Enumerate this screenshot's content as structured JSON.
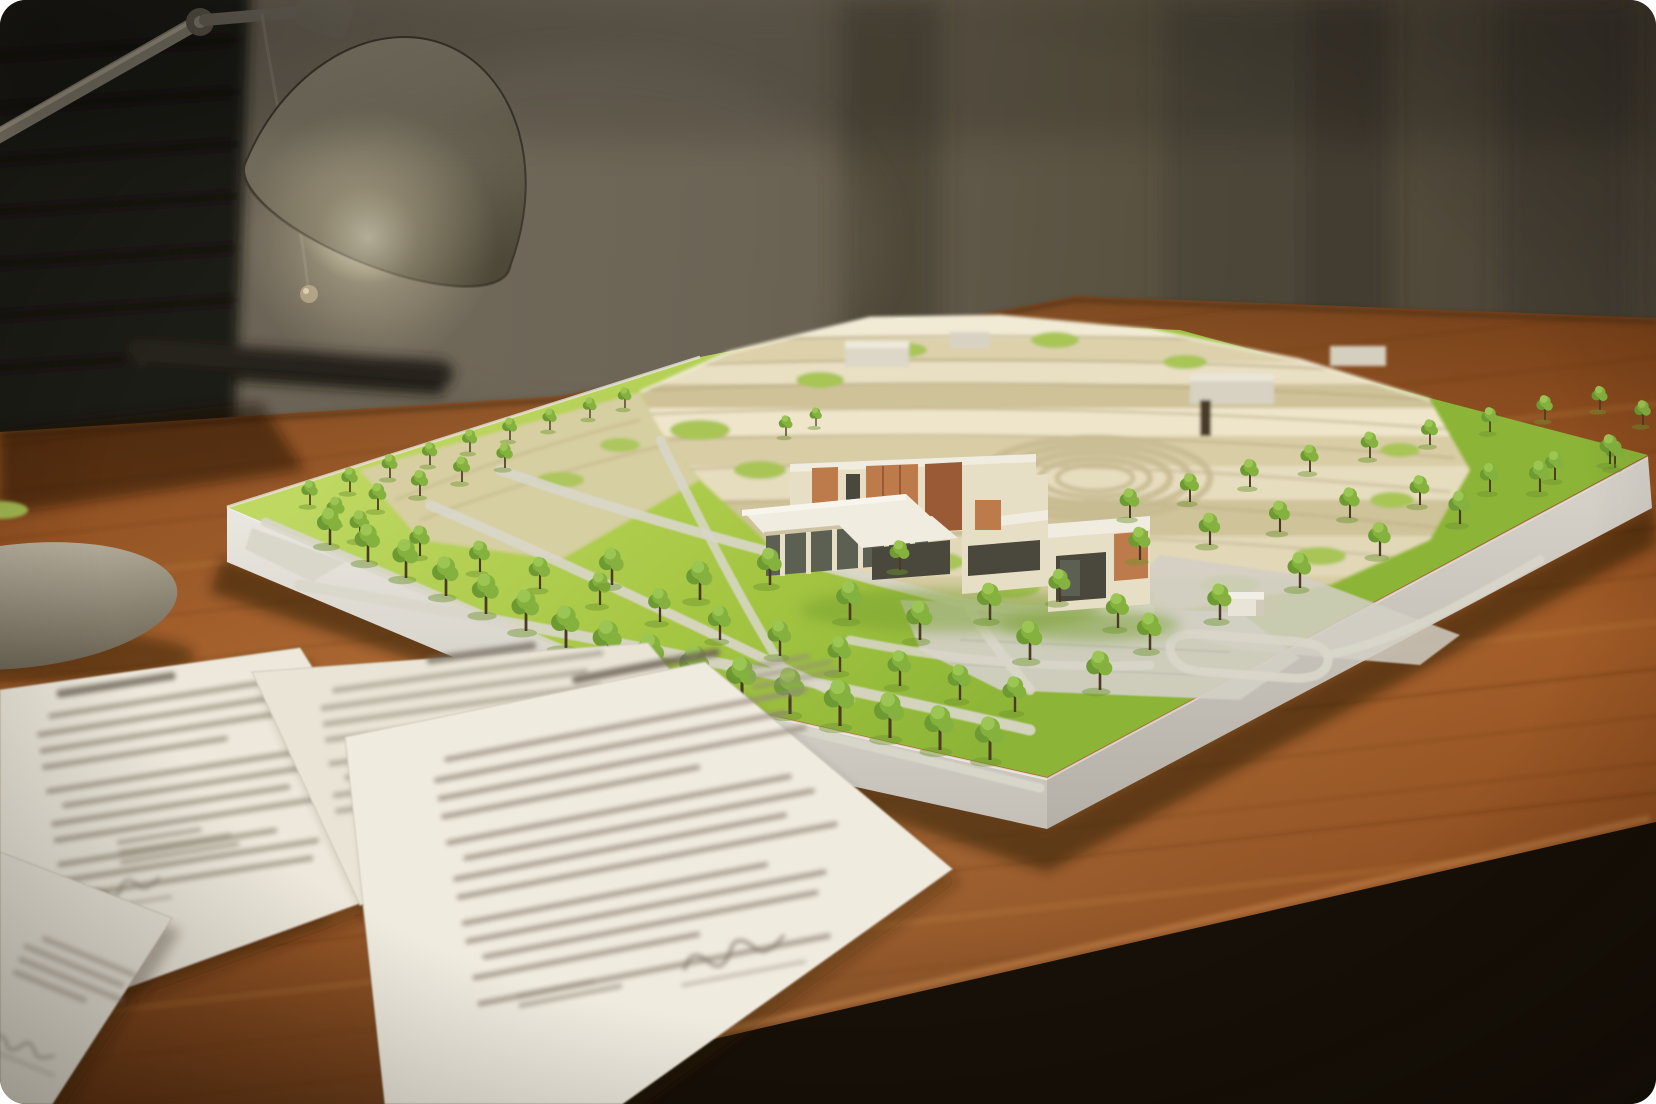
{
  "image": {
    "kind": "photograph",
    "subject": "Architectural terrain model of a hillside site with a modern building, trees and lawns, sitting on a wooden desk lit by a desk lamp, office chair behind, printed documents in the foreground"
  },
  "objects": [
    {
      "name": "office-chair",
      "desc": "dark leather ribbed chair, blurred, top left"
    },
    {
      "name": "desk-lamp",
      "desc": "olive-grey dome shade, articulated silver arm, glowing bulb, pull cord with ball"
    },
    {
      "name": "lamp-base",
      "desc": "round beige weighted base at left edge"
    },
    {
      "name": "desk",
      "desc": "warm reddish-brown wooden desk with grain streaks"
    },
    {
      "name": "architectural-model",
      "desc": "white baseboard, green lawns, grey footpaths, cream terraced hillside, modern cream building with terracotta slats, many miniature trees"
    },
    {
      "name": "documents",
      "desc": "overlapping white printed sheets with blurred illegible text and signatures"
    }
  ],
  "palette": {
    "wall": "#6f6759",
    "wallMid": "#5c5447",
    "wallDark": "#3b352b",
    "chair": "#1e1b17",
    "chairRib": "#121009",
    "deskTop": "#8c4c1e",
    "deskLight": "#a05a26",
    "deskDark": "#5f3111",
    "grainDark": "#5a2d0e",
    "grainLight": "#c9873f",
    "floor": "#171008",
    "lampShade": "#7b7463",
    "lampShadeLight": "#9a9280",
    "lampShadeDark": "#4e4839",
    "lampInner": "#f1ead5",
    "bulb": "#fffef4",
    "arm": "#867f6f",
    "armLight": "#b3ab97",
    "cord": "#7b7466",
    "cordBall": "#a3947a",
    "lampBase": "#b6ae9c",
    "boardSide": "#e9e6df",
    "boardSideDark": "#b9b5ad",
    "grass": "#a6c743",
    "grassLight": "#bfd862",
    "grassDark": "#8cb436",
    "terrace": "#e9e0c4",
    "terraceLight": "#f1ead4",
    "terraceMid": "#dcd1ab",
    "terraceDark": "#cfc298",
    "terraceShadow": "#b2a47c",
    "greenPatch": "#a9c557",
    "khaki": "#d8cfa5",
    "path": "#d9d6ca",
    "plaza": "#d2cfc4",
    "buildingWall": "#e7dec6",
    "buildingWallShade": "#cfc3a6",
    "slats": "#bd7a4a",
    "slatsDark": "#9a5a35",
    "windowDark": "#4a483c",
    "glass": "#5c6052",
    "roof": "#f1ece0",
    "canopy": "#85b23f",
    "canopyDark": "#6d9a33",
    "canopyLight": "#9cc653",
    "trunk": "#4c3b24",
    "treeShadow": "#6f942e",
    "paper": "#efeade",
    "ink": "#938a79",
    "inkDark": "#6e6557",
    "shadow": "#241204"
  },
  "trees": [
    [
      310,
      505,
      0.6
    ],
    [
      350,
      492,
      0.6
    ],
    [
      390,
      478,
      0.58
    ],
    [
      430,
      465,
      0.56
    ],
    [
      470,
      452,
      0.55
    ],
    [
      510,
      440,
      0.54
    ],
    [
      550,
      430,
      0.52
    ],
    [
      590,
      418,
      0.5
    ],
    [
      625,
      408,
      0.5
    ],
    [
      336,
      524,
      0.66
    ],
    [
      378,
      510,
      0.65
    ],
    [
      420,
      496,
      0.63
    ],
    [
      462,
      482,
      0.62
    ],
    [
      505,
      468,
      0.6
    ],
    [
      360,
      540,
      0.72
    ],
    [
      420,
      556,
      0.74
    ],
    [
      480,
      572,
      0.76
    ],
    [
      540,
      589,
      0.78
    ],
    [
      600,
      605,
      0.8
    ],
    [
      660,
      622,
      0.82
    ],
    [
      720,
      640,
      0.84
    ],
    [
      780,
      656,
      0.86
    ],
    [
      840,
      672,
      0.86
    ],
    [
      900,
      686,
      0.86
    ],
    [
      960,
      700,
      0.86
    ],
    [
      1015,
      712,
      0.86
    ],
    [
      330,
      545,
      0.9
    ],
    [
      368,
      562,
      0.92
    ],
    [
      406,
      578,
      0.94
    ],
    [
      446,
      596,
      0.96
    ],
    [
      486,
      614,
      0.98
    ],
    [
      526,
      631,
      1.0
    ],
    [
      566,
      648,
      1.03
    ],
    [
      608,
      664,
      1.06
    ],
    [
      650,
      678,
      1.08
    ],
    [
      695,
      690,
      1.1
    ],
    [
      742,
      702,
      1.1
    ],
    [
      790,
      714,
      1.12
    ],
    [
      840,
      726,
      1.12
    ],
    [
      890,
      738,
      1.1
    ],
    [
      940,
      750,
      1.08
    ],
    [
      990,
      760,
      1.05
    ],
    [
      612,
      585,
      0.9
    ],
    [
      700,
      600,
      0.95
    ],
    [
      770,
      585,
      0.9
    ],
    [
      850,
      620,
      0.95
    ],
    [
      920,
      640,
      0.95
    ],
    [
      990,
      620,
      0.9
    ],
    [
      1030,
      660,
      0.95
    ],
    [
      900,
      570,
      0.72
    ],
    [
      1060,
      602,
      0.8
    ],
    [
      1118,
      628,
      0.84
    ],
    [
      786,
      436,
      0.5
    ],
    [
      816,
      426,
      0.45
    ],
    [
      1130,
      518,
      0.72
    ],
    [
      1190,
      502,
      0.7
    ],
    [
      1250,
      487,
      0.68
    ],
    [
      1310,
      472,
      0.66
    ],
    [
      1370,
      458,
      0.64
    ],
    [
      1430,
      445,
      0.62
    ],
    [
      1490,
      432,
      0.6
    ],
    [
      1545,
      420,
      0.6
    ],
    [
      1600,
      410,
      0.58
    ],
    [
      1643,
      425,
      0.6
    ],
    [
      1140,
      560,
      0.8
    ],
    [
      1210,
      545,
      0.78
    ],
    [
      1280,
      532,
      0.76
    ],
    [
      1350,
      518,
      0.74
    ],
    [
      1420,
      505,
      0.72
    ],
    [
      1490,
      492,
      0.7
    ],
    [
      1555,
      480,
      0.7
    ],
    [
      1615,
      468,
      0.68
    ],
    [
      1150,
      650,
      0.9
    ],
    [
      1220,
      620,
      0.88
    ],
    [
      1300,
      588,
      0.86
    ],
    [
      1380,
      556,
      0.82
    ],
    [
      1460,
      524,
      0.8
    ],
    [
      1540,
      492,
      0.76
    ],
    [
      1610,
      464,
      0.72
    ],
    [
      1100,
      690,
      0.95
    ]
  ],
  "text_line_widths": [
    0.96,
    0.9,
    0.94,
    0.66,
    0.88,
    0.93,
    0.85,
    0.97,
    0.78,
    0.92,
    0.89,
    0.58,
    0.9,
    0.95,
    0.83,
    0.7,
    0.91,
    0.87
  ],
  "paper_sheets": [
    {
      "name": "doc-sheet-under-left",
      "points": "0,755 200,706 320,908 30,1005",
      "fill": "#e2dccd",
      "text": {
        "rot": -14,
        "ox": 60,
        "oy": 780,
        "rows": 5,
        "w": 180,
        "lh": 15,
        "op": 0.35
      }
    },
    {
      "name": "doc-sheet-left",
      "points": "0,690 300,648 440,874 70,1008 0,1008",
      "fill": "#ede8db",
      "text": {
        "rot": -9,
        "ox": 34,
        "oy": 716,
        "rows": 11,
        "w": 285,
        "lh": 16.5,
        "op": 0.7
      },
      "header": {
        "x": 60,
        "y": 694,
        "w": 120
      },
      "extra": [
        {
          "x": 96,
          "y": 852,
          "rows": 3,
          "w": 130,
          "lh": 10
        },
        {
          "x": 40,
          "y": 930,
          "rows": 2,
          "w": 90,
          "lh": 9
        }
      ],
      "sig": {
        "x": 60,
        "y": 905,
        "s": 0.8
      }
    },
    {
      "name": "doc-sheet-middle",
      "points": "252,672 648,643 770,793 360,905",
      "fill": "#e9e4d6",
      "text": {
        "rot": -8,
        "ox": 318,
        "oy": 690,
        "rows": 8,
        "w": 300,
        "lh": 16,
        "op": 0.6
      },
      "header": {
        "x": 430,
        "y": 672,
        "w": 110
      }
    },
    {
      "name": "doc-sheet-right",
      "points": "345,737 705,662 952,869 622,1104 385,1104",
      "fill": "#f0ebdf",
      "text": {
        "rot": -11,
        "ox": 430,
        "oy": 760,
        "rows": 13,
        "w": 400,
        "lh": 18.5,
        "op": 0.75
      },
      "header": {
        "x": 585,
        "y": 705,
        "w": 150
      },
      "extra": [
        {
          "x": 760,
          "y": 728,
          "rows": 3,
          "w": 95,
          "lh": 10
        },
        {
          "x": 470,
          "y": 1006,
          "rows": 2,
          "w": 120,
          "lh": 10
        }
      ],
      "sig": {
        "x": 640,
        "y": 1014,
        "s": 1.15
      }
    },
    {
      "name": "doc-sheet-corner",
      "points": "0,852 172,918 52,1104 0,1104",
      "fill": "#eae5d8",
      "text": {
        "rot": 22,
        "ox": 30,
        "oy": 930,
        "rows": 4,
        "w": 120,
        "lh": 14,
        "op": 0.5
      },
      "sig": {
        "x": 36,
        "y": 1046,
        "s": 0.7
      }
    }
  ]
}
